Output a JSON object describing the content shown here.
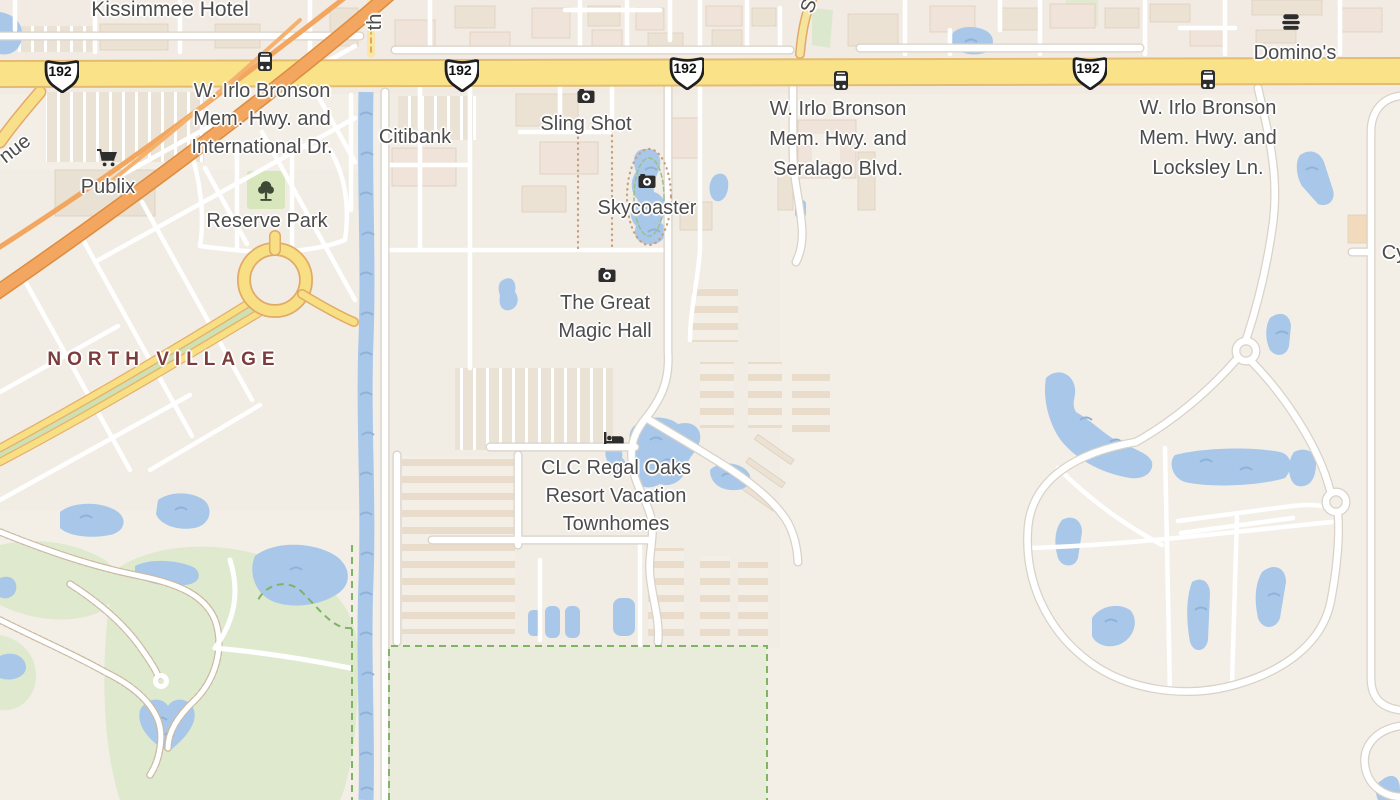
{
  "map": {
    "type": "street-map-tile-view",
    "area": "Kissimmee, FL — W. Irlo Bronson Memorial Hwy corridor"
  },
  "roads": {
    "route_number": "192",
    "shield_count": 4
  },
  "labels": {
    "kissimmee_hotel": "Kissimmee Hotel",
    "irlo_international": "W. Irlo Bronson\nMem. Hwy. and\nInternational Dr.",
    "irlo_seralago": "W. Irlo Bronson\nMem. Hwy. and\nSeralago Blvd.",
    "irlo_locksley": "W. Irlo Bronson\nMem. Hwy. and\nLocksley Ln.",
    "publix": "Publix",
    "reserve_park": "Reserve Park",
    "north_village": "NORTH VILLAGE",
    "citibank": "Citibank",
    "sling_shot": "Sling Shot",
    "skycoaster": "Skycoaster",
    "great_magic_hall": "The Great\nMagic Hall",
    "clc_regal_oaks": "CLC Regal Oaks\nResort Vacation\nTownhomes",
    "dominos": "Domino's",
    "street_fragment_th": "th",
    "street_fragment_nue": "nue",
    "street_fragment_s": "S",
    "street_fragment_cy": "Cy"
  },
  "icons": {
    "camera_icon": "dark rounded camera glyph (attraction/photo POI)",
    "bus_stop_icon": "dark bus front glyph on highway",
    "lodging_icon": "dark bed glyph (hotel/resort POI)",
    "park_tree_icon": "dark tree silhouette (park POI)",
    "supermarket_cart_icon": "dark shopping cart glyph",
    "fast_food_icon": "dark stacked burger glyph (restaurant POI)",
    "us_route_shield": "white US-route badge with black border"
  },
  "colors": {
    "land": "#f3efe7",
    "water": "#a9c7e9",
    "water_wave": "#8fb2d9",
    "green_area": "#dfe9cd",
    "field_fill": "#e9ecda",
    "boundary_green": "#7fb465",
    "road_white": "#ffffff",
    "road_casing": "#d8d2c7",
    "highway_yellow": "#fae289",
    "highway_casing": "#e3bc72",
    "motorway_orange": "#f2a65f",
    "motorway_casing": "#de8c3e",
    "building": "#ece2d4",
    "building_outline": "#dccfbd",
    "label_color": "#4c4c4c",
    "district_label_color": "#7d3c3c",
    "icon_color": "#333333",
    "trail_dot": "#c7a07b"
  }
}
